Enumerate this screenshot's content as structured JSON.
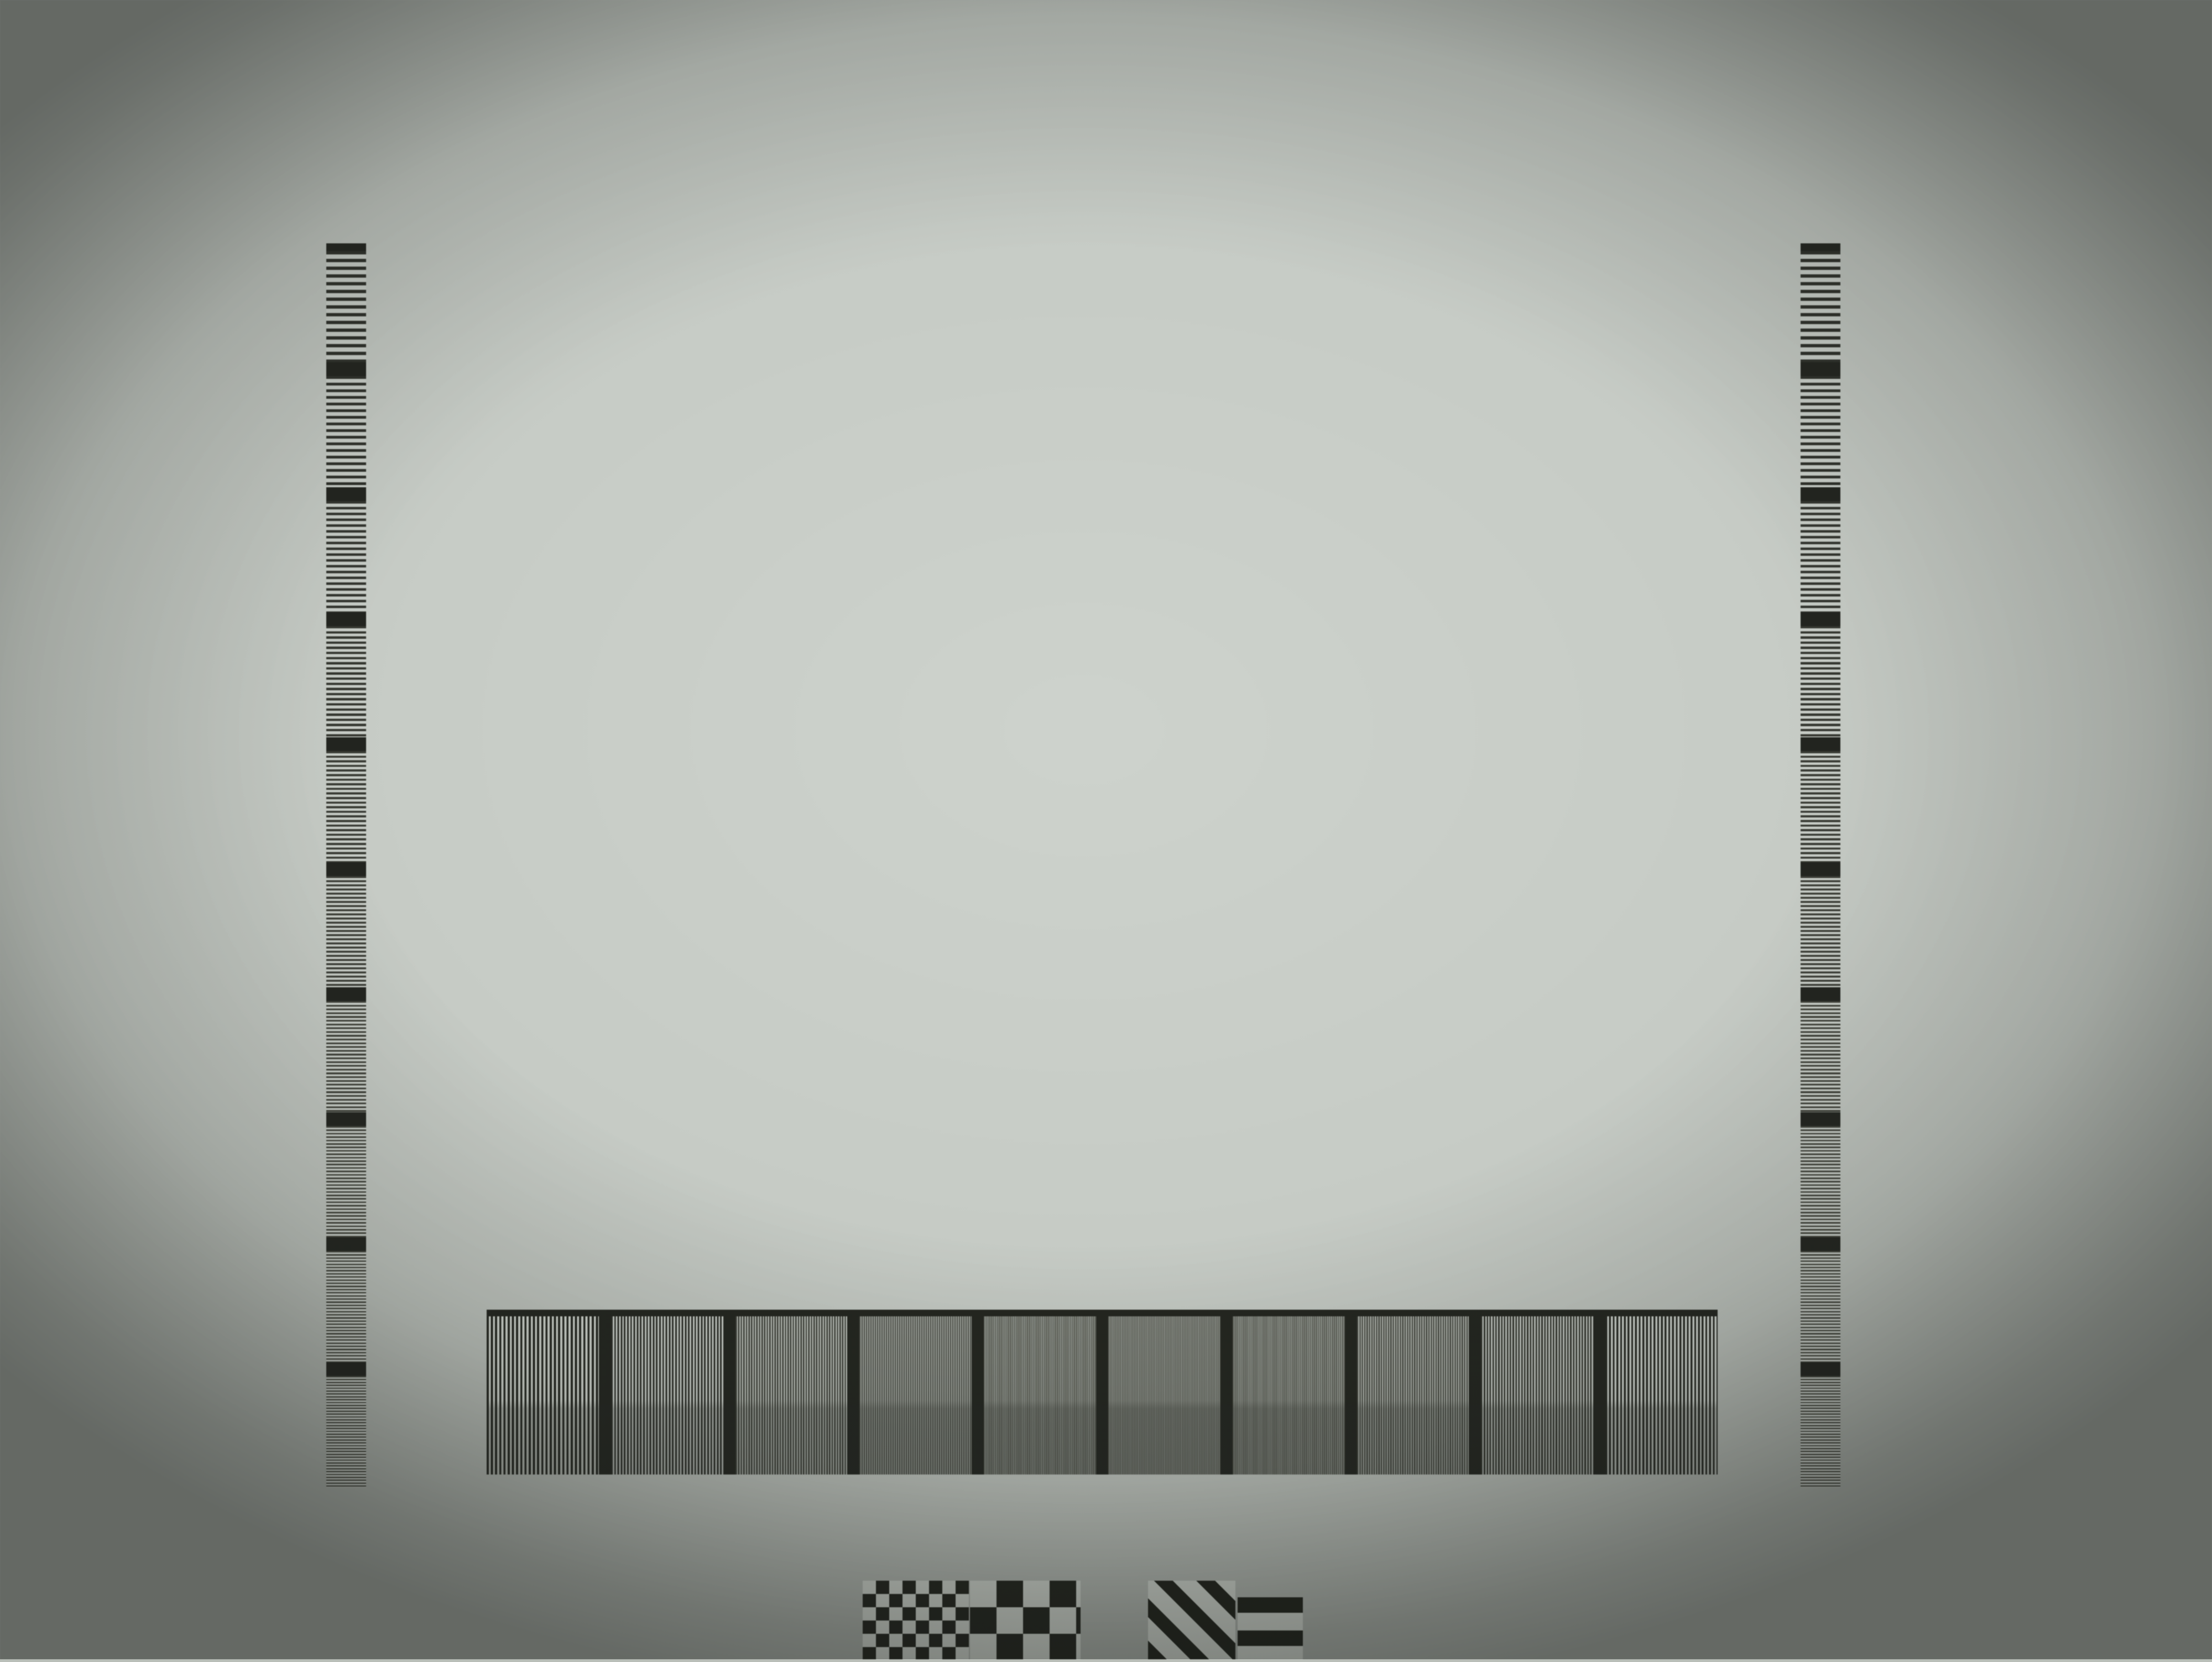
{
  "meta": {
    "subject": "ISO 12233 style camera resolution test chart (photograph)"
  },
  "colors": {
    "paper": "#c6cbc5",
    "ink": "#262822",
    "gray_patch": "#8d908a",
    "dark_patch": "#43463e"
  },
  "top_ruler": {
    "start": "1",
    "end": "10"
  },
  "corner_marks": {
    "top_left_ratio": "1:1",
    "top_right_ratio": "1:1",
    "bottom_left_ratio": "1:1",
    "bottom_right_ratio": "1:1",
    "top_right_aspect": "4:3",
    "bottom_right_aspect": "4:3",
    "top_left_fragment": "3"
  },
  "left_scale": [
    "12",
    "14",
    "16",
    "18",
    "20",
    "22",
    "24",
    "26",
    "28",
    "30"
  ],
  "right_scale": [
    "12",
    "16",
    "20",
    "24",
    "28",
    "30",
    "26",
    "22",
    "18",
    "14"
  ],
  "upper_left_wedge": [
    "6",
    "7",
    "8",
    "9"
  ],
  "upper_right_wedge": [
    "12",
    "14",
    "16",
    "18"
  ],
  "center_wedge_scale": [
    "6",
    "8",
    "10",
    "12",
    "14",
    "16",
    "18",
    "20"
  ],
  "right_wedge_scale": [
    "12",
    "16",
    "20",
    "24",
    "28",
    "32",
    "36",
    "40"
  ],
  "mid_ruler_left": [
    "6",
    "8",
    "10",
    "12",
    "14",
    "16",
    "18"
  ],
  "mid_ruler_right": [
    "36",
    "32",
    "28",
    "24",
    "20",
    "16",
    "12"
  ],
  "bottom_bars_top": [
    "12",
    "16",
    "20",
    "24",
    "28",
    "30",
    "26",
    "22",
    "18",
    "14"
  ],
  "bottom_bars_bottom": [
    "12",
    "14",
    "16",
    "18",
    "20",
    "22",
    "24",
    "26",
    "28",
    "30"
  ],
  "edge_left": {
    "row1": [
      "16",
      "14",
      "12"
    ],
    "row2": [
      "16",
      "14",
      "12"
    ]
  },
  "edge_right": {
    "row1": [
      "12",
      "14",
      "16",
      "18"
    ],
    "row2": [
      "12",
      "14",
      "16",
      "18"
    ],
    "top_digits": [
      "6",
      "7",
      "8",
      "9"
    ],
    "bottom_digits": [
      "9",
      "8",
      "7",
      "6"
    ]
  }
}
